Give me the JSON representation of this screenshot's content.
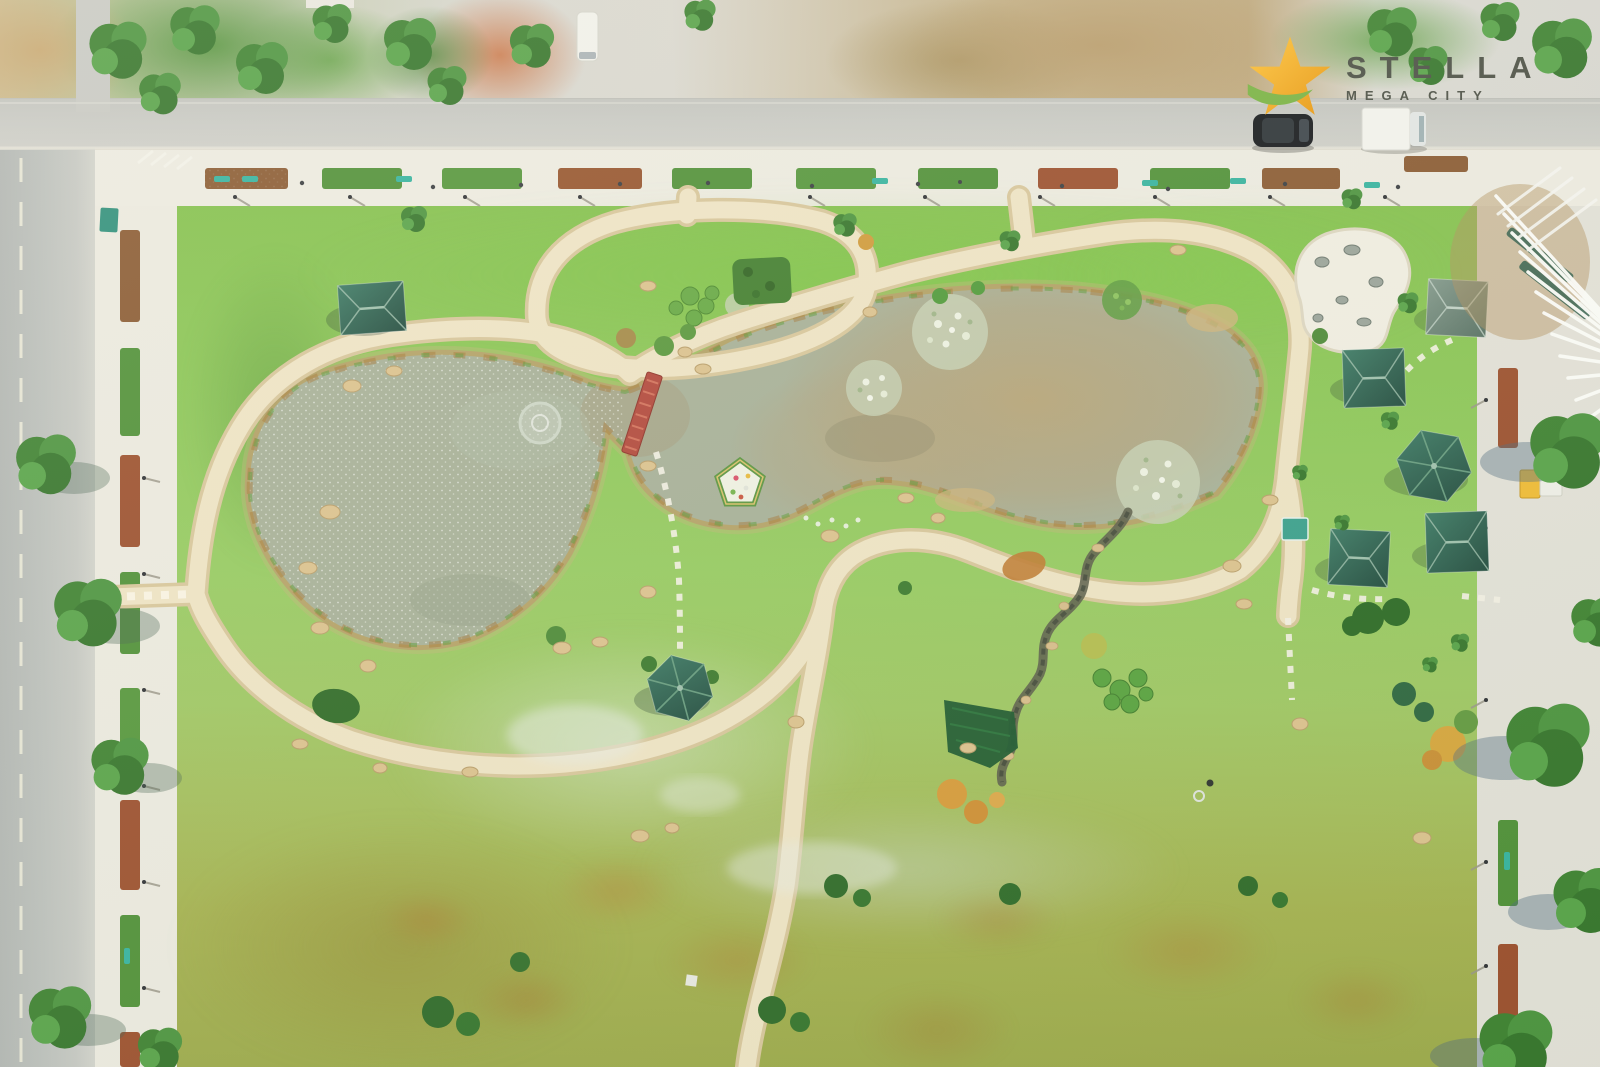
{
  "logo": {
    "title": "STELLA",
    "subtitle": "MEGA CITY",
    "star_color": "#F2A71B",
    "swoosh_color": "#79B344",
    "text_color": "#4B4F46"
  },
  "palette": {
    "logo-gold": "#F2A71B",
    "logo-green": "#79B344",
    "logo-text": "#4B4F46",
    "lawn-green": "#8CC553",
    "path-cream": "#EFE4C6",
    "water-gray-green": "#A7B099",
    "water-muddy": "#B7A379",
    "roof-green": "#2F6355",
    "bridge-red": "#B2473C",
    "promenade-white": "#EDEBE2",
    "road-gray": "#BCC0BD",
    "bench-teal": "#35B3A0"
  },
  "scene": {
    "description": "Aerial drone view of a landscaped park: two connected ponds with lily clusters and a fountain ring, winding cream walking paths, a red footbridge, green-roofed pavilions, a white rock garden, tree-lined promenades with flower planters, and roads with parked vehicles.",
    "ponds": 2,
    "pavilions": 7,
    "red_bridge": 1,
    "fountain_rings": 1,
    "parked_vehicles": [
      "black SUV",
      "white truck",
      "white van"
    ]
  }
}
